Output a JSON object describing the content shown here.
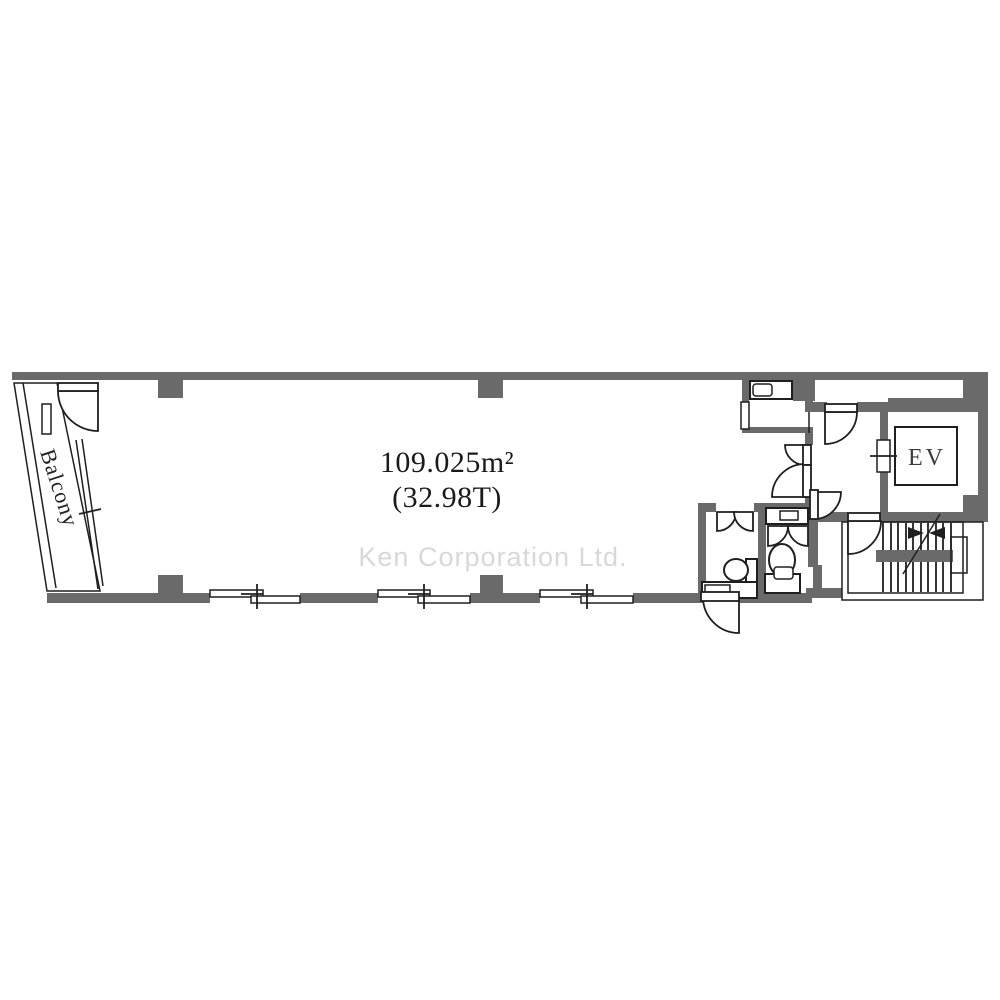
{
  "floorplan": {
    "main_room": {
      "area_m2": "109.025m²",
      "area_tsubo": "(32.98T)"
    },
    "labels": {
      "balcony": "Balcony",
      "elevator": "EV"
    },
    "watermark": "Ken Corporation Ltd.",
    "colors": {
      "wall": "#6a6a6a",
      "line": "#1f1f1f",
      "watermark": "#d8d8d8",
      "text": "#1a1a1a",
      "background": "#ffffff"
    }
  }
}
